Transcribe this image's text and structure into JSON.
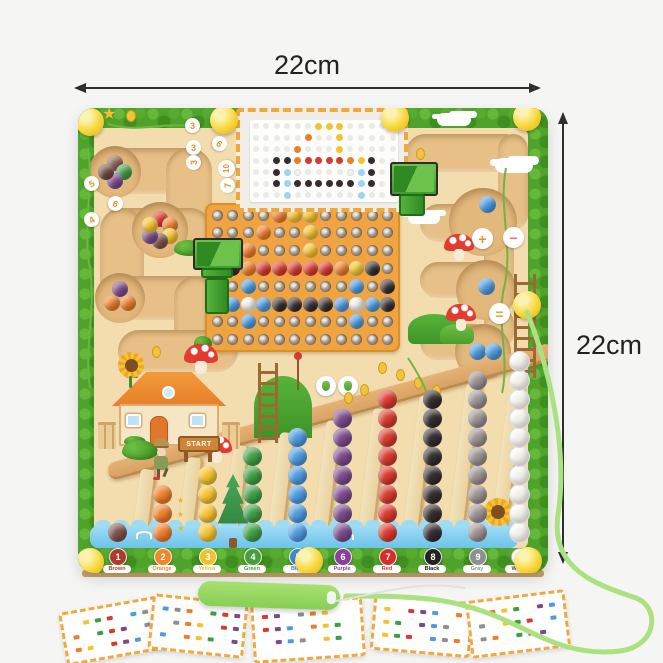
{
  "dimensions": {
    "top_label": "22cm",
    "right_label": "22cm"
  },
  "board": {
    "start_sign_label": "START",
    "icons": {
      "star": "★"
    },
    "colors": {
      "bush": "#4fa32b",
      "bush_dark": "#3e8f1f",
      "bush_light": "#69bb3c",
      "wood": "#f3dcae",
      "corridor": "#e7c088",
      "pegboard": "#f1a33f",
      "water": "#7ecdf0",
      "knob": "#f8d73a",
      "ramp": "#dca96c"
    },
    "maze_number_bubbles": [
      {
        "value": "3",
        "x": 107,
        "y": 10
      },
      {
        "value": "6",
        "x": 134,
        "y": 28,
        "rot": 40
      },
      {
        "value": "3",
        "x": 108,
        "y": 32
      },
      {
        "value": "3",
        "x": 108,
        "y": 47,
        "rot": -90
      },
      {
        "value": "10",
        "x": 140,
        "y": 52,
        "rot": -90
      },
      {
        "value": "7",
        "x": 142,
        "y": 70,
        "rot": -90
      },
      {
        "value": "5",
        "x": 6,
        "y": 68,
        "rot": -30
      },
      {
        "value": "6",
        "x": 30,
        "y": 88,
        "rot": 20
      },
      {
        "value": "4",
        "x": 6,
        "y": 104,
        "rot": -30
      }
    ],
    "math_bubbles": [
      {
        "symbol": "+",
        "x": 394,
        "y": 120,
        "color": "#ef8a2a"
      },
      {
        "symbol": "−",
        "x": 425,
        "y": 119,
        "color": "#e8698a"
      },
      {
        "symbol": "=",
        "x": 411,
        "y": 195,
        "color": "#efa22a"
      }
    ],
    "pattern_card_rows": [
      "______YYY_____",
      "_____O__Y_____",
      "____O___Y_____",
      "__KKORRRROYK__",
      "__KLW____WLK__",
      "__KLKKKKKKLK__",
      "___L______L___"
    ],
    "pegboard_rows": [
      "____OYY_____",
      "___O__Y_____",
      "__O___Y_____",
      "NKORRRRROYK_",
      "N_B______B_K",
      "KBWBKKKKBWBK",
      "__B______B__",
      "____________"
    ],
    "bead_palette": {
      "N": "#7d5147",
      "O": "#ee7d2b",
      "Y": "#f5c22f",
      "R": "#d93a2e",
      "K": "#332d30",
      "B": "#4d9be0",
      "W": "#f4f1ea",
      "L": "#9fd4ee"
    },
    "maze_pockets": [
      {
        "x": 37,
        "y": 64,
        "r": 26,
        "beads": [
          "#8a5f55",
          "#3f9e44",
          "#7b4a8c",
          "#6e4a42"
        ]
      },
      {
        "x": 82,
        "y": 122,
        "r": 28,
        "beads": [
          "#d93a2e",
          "#ee7d2b",
          "#f5c22f",
          "#7d5147",
          "#7b4a8c",
          "#f5c22f"
        ]
      },
      {
        "x": 42,
        "y": 190,
        "r": 25,
        "beads": [
          "#7b4a8c",
          "#ee7d2b",
          "#ee7d2b"
        ]
      }
    ],
    "track_beads": [
      {
        "x": 409,
        "y": 96
      },
      {
        "x": 408,
        "y": 178
      },
      {
        "x": 399,
        "y": 243
      },
      {
        "x": 415,
        "y": 243
      }
    ],
    "track_bead_color": "#4d9be0",
    "columns": [
      {
        "number": "1",
        "label": "Brown",
        "bead": "#7d5147",
        "badge": "#b03a2e",
        "count": 1
      },
      {
        "number": "2",
        "label": "Orange",
        "bead": "#ee7d2b",
        "badge": "#f0872a",
        "count": 3
      },
      {
        "number": "3",
        "label": "Yellow",
        "bead": "#f5c22f",
        "badge": "#eec12e",
        "count": 4
      },
      {
        "number": "4",
        "label": "Green",
        "bead": "#3f9e44",
        "badge": "#47a03c",
        "count": 5
      },
      {
        "number": "5",
        "label": "Blue",
        "bead": "#4d9be0",
        "badge": "#3f87d6",
        "count": 6
      },
      {
        "number": "6",
        "label": "Purple",
        "bead": "#7b4a8c",
        "badge": "#8a3f9e",
        "count": 7
      },
      {
        "number": "7",
        "label": "Red",
        "bead": "#d93a2e",
        "badge": "#d62f2a",
        "count": 8
      },
      {
        "number": "8",
        "label": "Black",
        "bead": "#332d30",
        "badge": "#222222",
        "count": 8
      },
      {
        "number": "9",
        "label": "Gray",
        "bead": "#9b9191",
        "badge": "#8f8f8f",
        "count": 9
      },
      {
        "number": "10",
        "label": "White",
        "bead": "#f2efe9",
        "badge": "#ffffff",
        "badge_text": "#555555",
        "count": 10
      }
    ]
  },
  "accessories": {
    "pen_color": "#86cf55",
    "cord_color": "#abe181",
    "cards": [
      {
        "rot": -10
      },
      {
        "rot": 6
      },
      {
        "rot": -4
      },
      {
        "rot": 5
      },
      {
        "rot": -7
      }
    ],
    "card_dot_colors": [
      "#ee7d2b",
      "#4d9be0",
      "#d93a2e",
      "#f5c22f",
      "#8f8f8f",
      "#7b4a8c",
      "#3f9e44"
    ]
  }
}
